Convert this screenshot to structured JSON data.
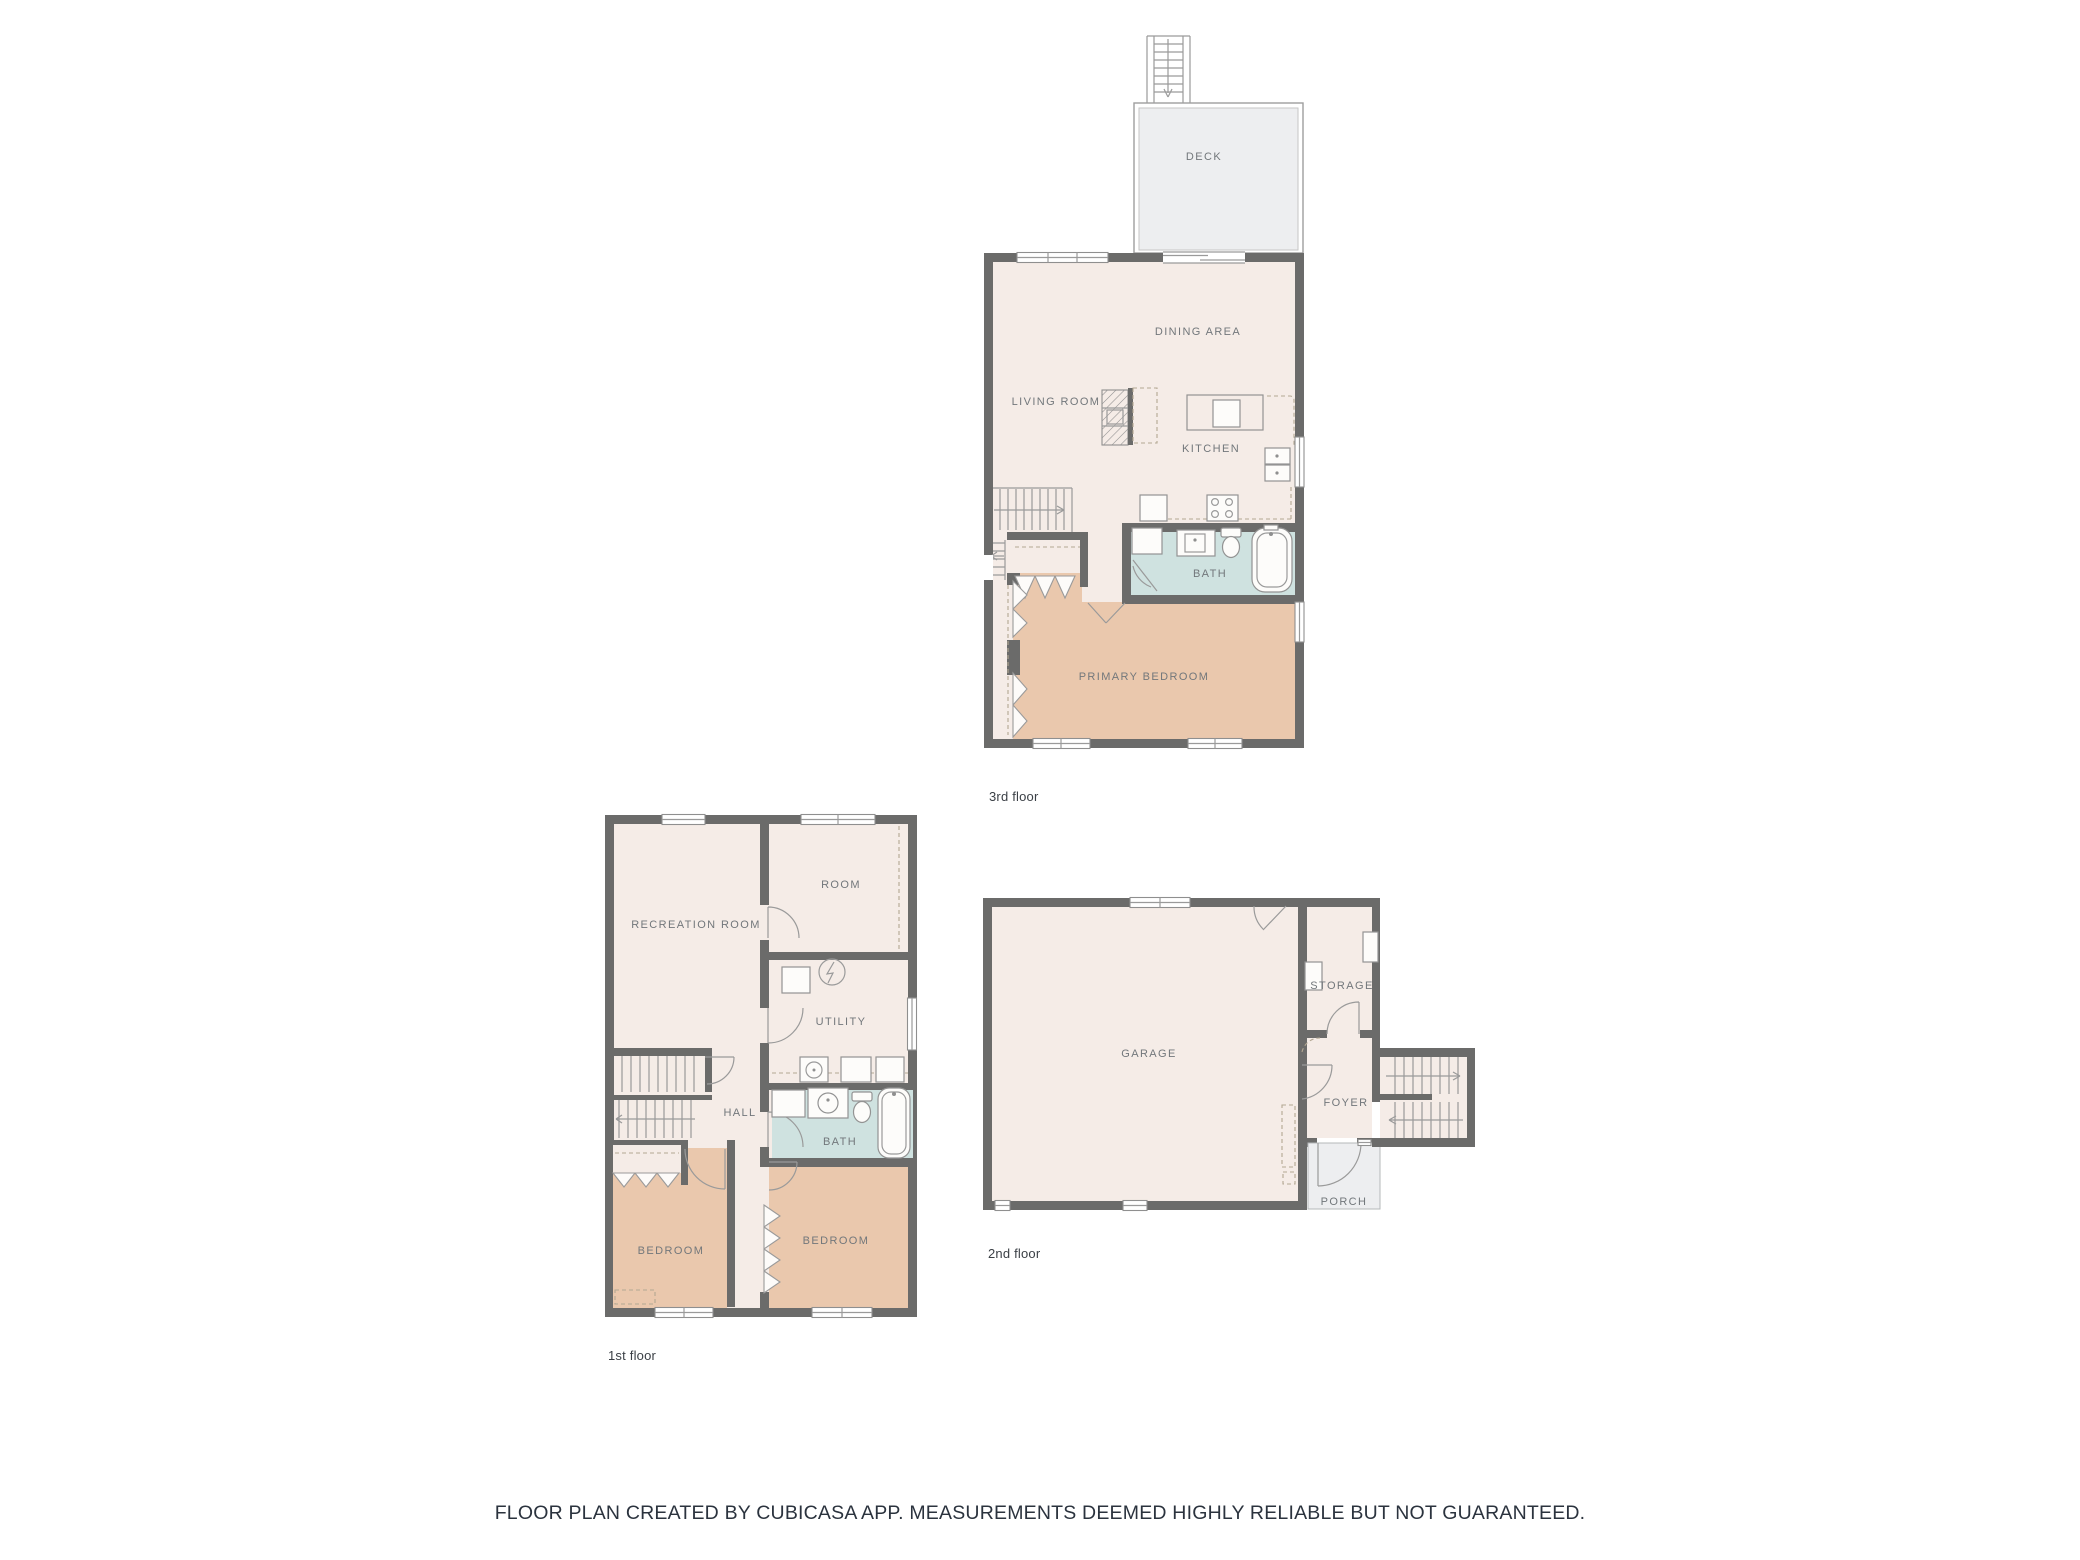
{
  "caption": "FLOOR PLAN CREATED BY CUBICASA APP. MEASUREMENTS DEEMED HIGHLY RELIABLE BUT NOT GUARANTEED.",
  "floors": {
    "third": {
      "name": "3rd floor",
      "rooms": {
        "deck": "DECK",
        "dining_area": "DINING AREA",
        "living_room": "LIVING ROOM",
        "kitchen": "KITCHEN",
        "bath": "BATH",
        "primary_bedroom": "PRIMARY BEDROOM"
      }
    },
    "first": {
      "name": "1st floor",
      "rooms": {
        "recreation_room": "RECREATION ROOM",
        "room": "ROOM",
        "utility": "UTILITY",
        "hall": "HALL",
        "bath": "BATH",
        "bedroom_left": "BEDROOM",
        "bedroom_right": "BEDROOM"
      }
    },
    "second": {
      "name": "2nd floor",
      "rooms": {
        "garage": "GARAGE",
        "storage": "STORAGE",
        "foyer": "FOYER",
        "porch": "PORCH"
      }
    }
  },
  "colors": {
    "wall": "#6b6b6a",
    "floor": "#f5ece7",
    "bedroom": "#eac8ad",
    "bath": "#cfe2e0",
    "outdoor": "#edeef0",
    "label": "#72777b",
    "caption_text": "#2b333e"
  }
}
